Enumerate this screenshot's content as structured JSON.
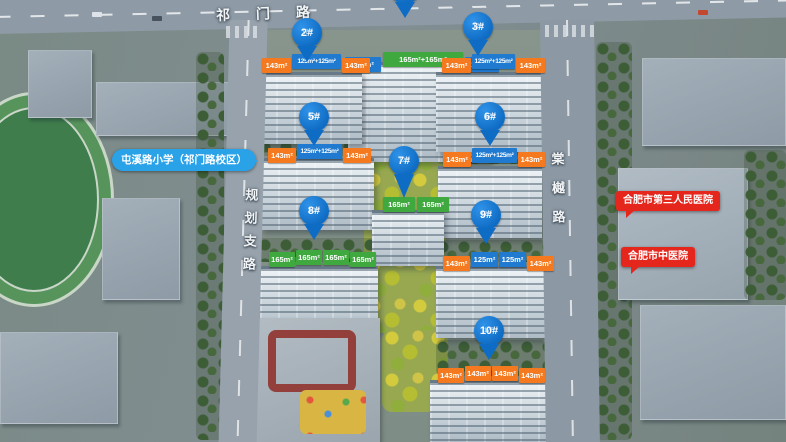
{
  "roads": {
    "top": "祁门路",
    "left": "规划支路",
    "right": "棠樾路"
  },
  "callouts": {
    "school": {
      "label": "屯溪路小学（祁门路校区）",
      "color": "#2aa2e8"
    },
    "hospital1": {
      "label": "合肥市第三人民医院",
      "color": "#e5261d"
    },
    "hospital2": {
      "label": "合肥市中医院",
      "color": "#e5261d"
    }
  },
  "buildings": [
    {
      "id": "1",
      "label": "",
      "floors": "",
      "flags": [
        {
          "text": "125m²",
          "type": "blue"
        },
        {
          "text": "165m²+165m²",
          "type": "green"
        },
        {
          "text": "125m²",
          "type": "blue"
        }
      ]
    },
    {
      "id": "2",
      "label": "2#",
      "floors": "17F",
      "flags": [
        {
          "text": "143m²",
          "type": "orange"
        },
        {
          "text": "125m²+125m²",
          "type": "blue"
        },
        {
          "text": "143m²",
          "type": "orange"
        }
      ]
    },
    {
      "id": "3",
      "label": "3#",
      "floors": "17F",
      "flags": [
        {
          "text": "143m²",
          "type": "orange"
        },
        {
          "text": "125m²+125m²",
          "type": "blue"
        },
        {
          "text": "143m²",
          "type": "orange"
        }
      ]
    },
    {
      "id": "5",
      "label": "5#",
      "floors": "17F",
      "flags": [
        {
          "text": "143m²",
          "type": "orange"
        },
        {
          "text": "125m²+125m²",
          "type": "blue"
        },
        {
          "text": "143m²",
          "type": "orange"
        }
      ]
    },
    {
      "id": "6",
      "label": "6#",
      "floors": "17F",
      "flags": [
        {
          "text": "143m²",
          "type": "orange"
        },
        {
          "text": "125m²+125m²",
          "type": "blue"
        },
        {
          "text": "143m²",
          "type": "orange"
        }
      ]
    },
    {
      "id": "7",
      "label": "7#",
      "floors": "12F",
      "flags": [
        {
          "text": "165m²",
          "type": "green"
        },
        {
          "text": "165m²",
          "type": "green"
        }
      ]
    },
    {
      "id": "8",
      "label": "8#",
      "floors": "10F",
      "flags": [
        {
          "text": "165m²",
          "type": "green"
        },
        {
          "text": "165m²",
          "type": "green"
        },
        {
          "text": "165m²",
          "type": "green"
        },
        {
          "text": "165m²",
          "type": "green"
        }
      ]
    },
    {
      "id": "9",
      "label": "9#",
      "floors": "17F",
      "flags": [
        {
          "text": "143m²",
          "type": "orange"
        },
        {
          "text": "125m²",
          "type": "blue"
        },
        {
          "text": "125m²",
          "type": "blue"
        },
        {
          "text": "143m²",
          "type": "orange"
        }
      ]
    },
    {
      "id": "10",
      "label": "10#",
      "floors": "17F",
      "flags": [
        {
          "text": "143m²",
          "type": "orange"
        },
        {
          "text": "143m²",
          "type": "orange"
        },
        {
          "text": "143m²",
          "type": "orange"
        },
        {
          "text": "143m²",
          "type": "orange"
        }
      ]
    }
  ],
  "colors": {
    "pin": "#0f6cc4",
    "flag_orange": "#f57a1f",
    "flag_blue": "#1f7ad0",
    "flag_green": "#3fa83f",
    "callout_blue": "#2aa2e8",
    "callout_red": "#e5261d"
  }
}
